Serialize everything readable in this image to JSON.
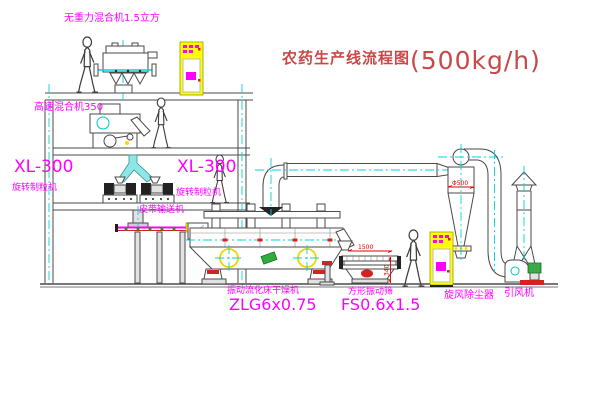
{
  "title": {
    "text": "农药生产线流程图",
    "capacity": "(500kg/h)"
  },
  "labels": {
    "gravity_mixer": "无重力混合机1.5立方",
    "high_speed_mixer": "高速混合机350",
    "granulator_left_model": "XL-300",
    "granulator_left_name": "旋转制粒机",
    "granulator_mid_model": "XL-300",
    "granulator_mid_name": "旋转制粒机",
    "belt_conveyor": "皮带输送机",
    "dryer_name": "振动流化床干燥机",
    "dryer_model": "ZLG6x0.75",
    "screen_name": "方形振动筛",
    "screen_model": "FS0.6x1.5",
    "cyclone_name": "旋风除尘器",
    "fan_name": "引风机"
  },
  "dimensions": {
    "screen_length": "1500",
    "screen_height": "340",
    "cyclone_diameter": "Φ500"
  },
  "colors": {
    "label_magenta": "#ff00ff",
    "title_red": "#c94848",
    "dimension_red": "#e00000",
    "centerline_cyan": "#00d5d5",
    "cabinet_yellow": "#ffff00",
    "line_gray": "#4a4a4a",
    "motor_green": "#2fae3a"
  }
}
